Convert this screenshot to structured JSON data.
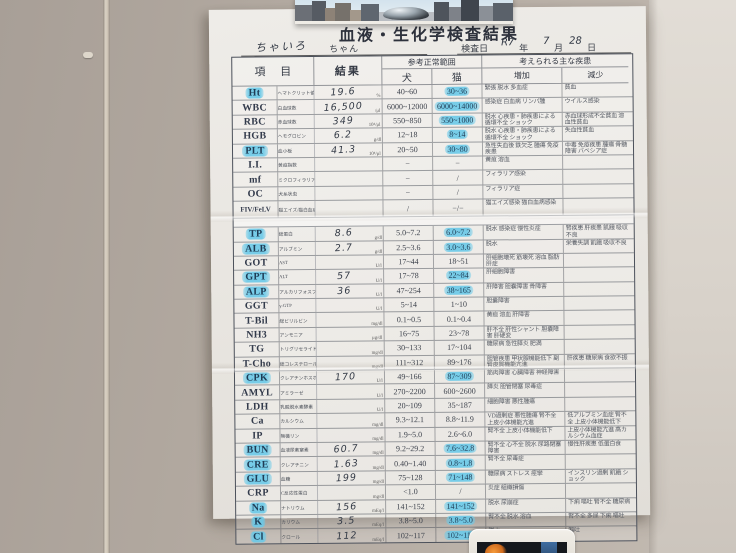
{
  "colors": {
    "wall": "#b2a9a0",
    "paper": "#e9e6e1",
    "highlight_marker": "#6ac9e8",
    "table_line": "#4c515b",
    "pen": "#333a46"
  },
  "document": {
    "title": "血液・生化学検査結果",
    "patient": {
      "handwritten_name": "ちゃいろ",
      "name_suffix": "ちゃん"
    },
    "exam_date": {
      "label": "検査日",
      "era_year": "R7",
      "year_suffix": "年",
      "month": "7",
      "month_suffix": "月",
      "day": "28",
      "day_suffix": "日"
    },
    "header": {
      "item": "項 目",
      "result": "結果",
      "ref_range": "参考正常範囲",
      "dog": "犬",
      "cat": "猫",
      "diseases": "考えられる主な疾患",
      "increase": "増加",
      "decrease": "減少"
    },
    "rows": [
      {
        "sec": "h",
        "code": "Ht",
        "sub": "ヘマトクリット値",
        "result": "19.6",
        "unit": "%",
        "dog": "40~60",
        "cat": "30~36",
        "inc": "緊張 脱水 多血症",
        "dec": "貧血",
        "hlCode": true,
        "hlCat": true
      },
      {
        "sec": "h",
        "code": "WBC",
        "sub": "白血球数",
        "result": "16,500",
        "unit": "/μl",
        "dog": "6000~12000",
        "cat": "6000~14000",
        "inc": "感染症 白血病 リンパ腫",
        "dec": "ウイルス感染",
        "hlCode": false,
        "hlCat": true
      },
      {
        "sec": "h",
        "code": "RBC",
        "sub": "赤血球数",
        "result": "349",
        "unit": "10⁴/μl",
        "dog": "550~850",
        "cat": "550~1000",
        "inc": "脱水 心疾患・肺疾患による循環不全 ショック",
        "dec": "赤血球形成不全貧血 溶血性貧血",
        "hlCode": false,
        "hlCat": true
      },
      {
        "sec": "h",
        "code": "HGB",
        "sub": "ヘモグロビン",
        "result": "6.2",
        "unit": "g/dl",
        "dog": "12~18",
        "cat": "8~14",
        "inc": "脱水 心疾患・肺疾患による循環不全 ショック",
        "dec": "失血性貧血",
        "hlCode": false,
        "hlCat": true
      },
      {
        "sec": "h",
        "code": "PLT",
        "sub": "血小板",
        "result": "41.3",
        "unit": "10⁴/μl",
        "dog": "20~50",
        "cat": "30~80",
        "inc": "急性失血後 鉄欠乏 腫瘍 免疫疾患",
        "dec": "中毒 免疫疾患 腫瘍 骨髄障害 バベシア症",
        "hlCode": true,
        "hlCat": true
      },
      {
        "sec": "h",
        "code": "I.I.",
        "sub": "黄疸指数",
        "result": "",
        "unit": "",
        "dog": "−",
        "cat": "−",
        "inc": "黄疸 溶血",
        "dec": "",
        "hlCode": false,
        "hlCat": false
      },
      {
        "sec": "h",
        "code": "mf",
        "sub": "ミクロフィラリア",
        "result": "",
        "unit": "",
        "dog": "−",
        "cat": "/",
        "inc": "フィラリア感染",
        "dec": "",
        "hlCode": false,
        "hlCat": false
      },
      {
        "sec": "h",
        "code": "OC",
        "sub": "犬糸状虫",
        "result": "",
        "unit": "",
        "dog": "−",
        "cat": "/",
        "inc": "フィラリア症",
        "dec": "",
        "hlCode": false,
        "hlCat": false
      },
      {
        "sec": "h",
        "code": "FIV/FeLV",
        "sub": "猫エイズ/猫白血病",
        "result": "",
        "unit": "",
        "dog": "/",
        "cat": "−/−",
        "inc": "猫エイズ感染 猫白血病感染",
        "dec": "",
        "hlCode": false,
        "hlCat": false
      },
      {
        "sec": "c",
        "code": "TP",
        "sub": "総蛋白",
        "result": "8.6",
        "unit": "g/dl",
        "dog": "5.0~7.2",
        "cat": "6.0~7.2",
        "inc": "脱水 感染症 慢性炎症",
        "dec": "腎疾患 肝疾患 飢餓 吸収不良",
        "hlCode": true,
        "hlCat": true
      },
      {
        "sec": "c",
        "code": "ALB",
        "sub": "アルブミン",
        "result": "2.7",
        "unit": "g/dl",
        "dog": "2.5~3.6",
        "cat": "3.0~3.6",
        "inc": "脱水",
        "dec": "栄養失調 飢餓 吸収不良",
        "hlCode": true,
        "hlCat": true
      },
      {
        "sec": "c",
        "code": "GOT",
        "sub": "AST",
        "result": "",
        "unit": "U/l",
        "dog": "17~44",
        "cat": "18~51",
        "inc": "肝細胞壊死 筋壊死 溶血 脂肪肝症",
        "dec": "",
        "hlCode": false,
        "hlCat": false
      },
      {
        "sec": "c",
        "code": "GPT",
        "sub": "ALT",
        "result": "57",
        "unit": "U/l",
        "dog": "17~78",
        "cat": "22~84",
        "inc": "肝細胞障害",
        "dec": "",
        "hlCode": true,
        "hlCat": true
      },
      {
        "sec": "c",
        "code": "ALP",
        "sub": "アルカリフォスファターゼ",
        "result": "36",
        "unit": "U/l",
        "dog": "47~254",
        "cat": "38~165",
        "inc": "肝障害 胆嚢障害 骨障害",
        "dec": "",
        "hlCode": true,
        "hlCat": true
      },
      {
        "sec": "c",
        "code": "GGT",
        "sub": "γ-GTP",
        "result": "",
        "unit": "U/l",
        "dog": "5~14",
        "cat": "1~10",
        "inc": "胆嚢障害",
        "dec": "",
        "hlCode": false,
        "hlCat": false
      },
      {
        "sec": "c",
        "code": "T-Bil",
        "sub": "総ビリルビン",
        "result": "",
        "unit": "mg/dl",
        "dog": "0.1~0.5",
        "cat": "0.1~0.4",
        "inc": "黄疸 溶血 肝障害",
        "dec": "",
        "hlCode": false,
        "hlCat": false
      },
      {
        "sec": "c",
        "code": "NH3",
        "sub": "アンモニア",
        "result": "",
        "unit": "μg/dl",
        "dog": "16~75",
        "cat": "23~78",
        "inc": "肝不全 肝性シャント 胆嚢障害 肝硬変",
        "dec": "",
        "hlCode": false,
        "hlCat": false
      },
      {
        "sec": "c",
        "code": "TG",
        "sub": "トリグリセライド",
        "result": "",
        "unit": "mg/dl",
        "dog": "30~133",
        "cat": "17~104",
        "inc": "糖尿病 急性膵炎 肥満",
        "dec": "",
        "hlCode": false,
        "hlCat": false
      },
      {
        "sec": "c",
        "code": "T-Cho",
        "sub": "総コレステロール",
        "result": "",
        "unit": "mg/dl",
        "dog": "111~312",
        "cat": "89~176",
        "inc": "胆管疾患 甲状腺機能低下 副腎皮質機能亢進",
        "dec": "肝疾患 糖尿病 食欲不振",
        "hlCode": false,
        "hlCat": false
      },
      {
        "sec": "c",
        "code": "CPK",
        "sub": "クレアチンホスホキナーゼ",
        "result": "170",
        "unit": "U/l",
        "dog": "49~166",
        "cat": "87~309",
        "inc": "筋肉障害 心臓障害 神経障害",
        "dec": "",
        "hlCode": true,
        "hlCat": true
      },
      {
        "sec": "c",
        "code": "AMYL",
        "sub": "アミラーゼ",
        "result": "",
        "unit": "U/l",
        "dog": "270~2200",
        "cat": "600~2600",
        "inc": "膵炎 胆管閉塞 尿毒症",
        "dec": "",
        "hlCode": false,
        "hlCat": false
      },
      {
        "sec": "c",
        "code": "LDH",
        "sub": "乳酸脱水素酵素",
        "result": "",
        "unit": "U/l",
        "dog": "20~109",
        "cat": "35~187",
        "inc": "細胞障害 悪性腫瘍",
        "dec": "",
        "hlCode": false,
        "hlCat": false
      },
      {
        "sec": "c",
        "code": "Ca",
        "sub": "カルシウム",
        "result": "",
        "unit": "mg/dl",
        "dog": "9.3~12.1",
        "cat": "8.8~11.9",
        "inc": "VD過剰症 悪性腫瘍 腎不全 上皮小体機能亢進",
        "dec": "低アルブミン血症 腎不全 上皮小体機能低下",
        "hlCode": false,
        "hlCat": false
      },
      {
        "sec": "c",
        "code": "IP",
        "sub": "無機リン",
        "result": "",
        "unit": "mg/dl",
        "dog": "1.9~5.0",
        "cat": "2.6~6.0",
        "inc": "腎不全 上皮小体機能低下",
        "dec": "上皮小体機能亢進 高カルシウム血症",
        "hlCode": false,
        "hlCat": false
      },
      {
        "sec": "c",
        "code": "BUN",
        "sub": "血液尿素窒素",
        "result": "60.7",
        "unit": "mg/dl",
        "dog": "9.2~29.2",
        "cat": "7.6~32.8",
        "inc": "腎不全 心不全 脱水 尿路閉塞障害",
        "dec": "慢性肝疾患 低蛋白食",
        "hlCode": true,
        "hlCat": true
      },
      {
        "sec": "c",
        "code": "CRE",
        "sub": "クレアチニン",
        "result": "1.63",
        "unit": "mg/dl",
        "dog": "0.40~1.40",
        "cat": "0.8~1.8",
        "inc": "腎不全 尿毒症",
        "dec": "",
        "hlCode": true,
        "hlCat": true
      },
      {
        "sec": "c",
        "code": "GLU",
        "sub": "血糖",
        "result": "199",
        "unit": "mg/dl",
        "dog": "75~128",
        "cat": "71~148",
        "inc": "糖尿病 ストレス 痙攣",
        "dec": "インスリン過剰 飢餓 ショック",
        "hlCode": true,
        "hlCat": true
      },
      {
        "sec": "c",
        "code": "CRP",
        "sub": "C反応性蛋白",
        "result": "",
        "unit": "mg/dl",
        "dog": "<1.0",
        "cat": "/",
        "inc": "炎症 組織損傷",
        "dec": "",
        "hlCode": false,
        "hlCat": false
      },
      {
        "sec": "c",
        "code": "Na",
        "sub": "ナトリウム",
        "result": "156",
        "unit": "mEq/l",
        "dog": "141~152",
        "cat": "141~152",
        "inc": "脱水 尿崩症",
        "dec": "下痢 嘔吐 腎不全 糖尿病",
        "hlCode": true,
        "hlCat": true
      },
      {
        "sec": "c",
        "code": "K",
        "sub": "カリウム",
        "result": "3.5",
        "unit": "mEq/l",
        "dog": "3.8~5.0",
        "cat": "3.8~5.0",
        "inc": "腎不全 脱水 溶血",
        "dec": "腎不全 多尿 下痢 嘔吐",
        "hlCode": true,
        "hlCat": true
      },
      {
        "sec": "c",
        "code": "Cl",
        "sub": "クロール",
        "result": "112",
        "unit": "mEq/l",
        "dog": "102~117",
        "cat": "102~117",
        "inc": "脱水",
        "dec": "嘔吐",
        "hlCode": true,
        "hlCat": true
      }
    ]
  }
}
